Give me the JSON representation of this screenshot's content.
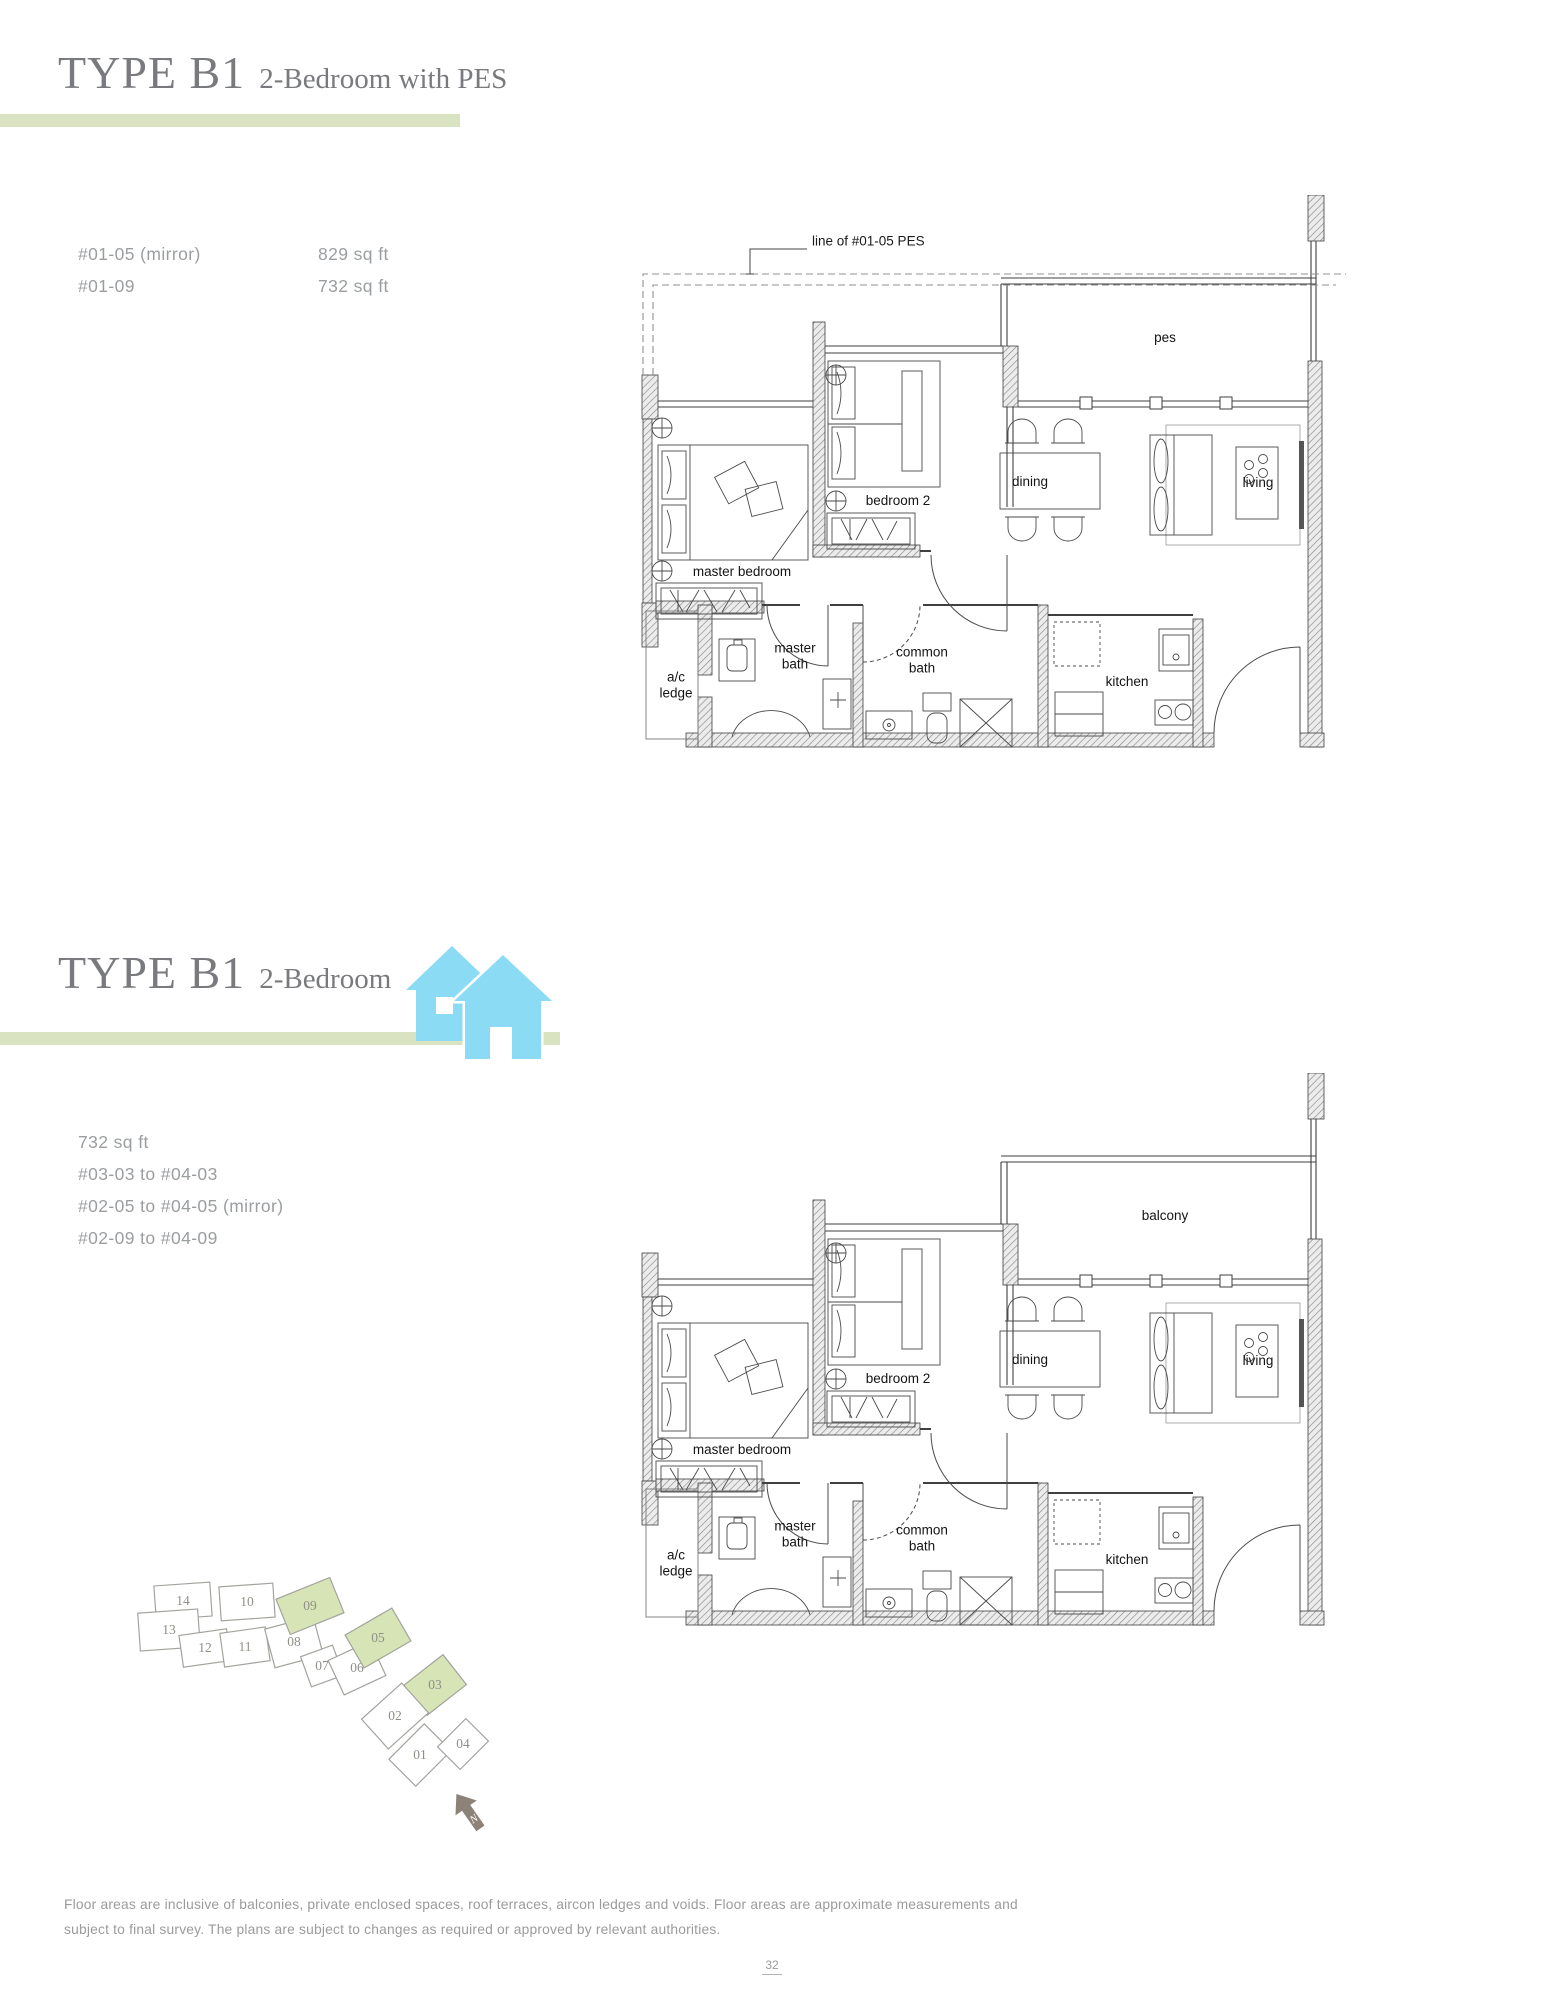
{
  "sections": [
    {
      "title": "TYPE B1",
      "subtitle": "2-Bedroom with PES",
      "unit_rows": [
        {
          "unit": "#01-05 (mirror)",
          "area": "829 sq ft"
        },
        {
          "unit": "#01-09",
          "area": "732 sq ft"
        }
      ],
      "plan": {
        "annotation": "line of #01-05 PES",
        "labels": {
          "outdoor": "pes",
          "dining": "dining",
          "living": "living",
          "bedroom2": "bedroom 2",
          "master_bedroom": "master bedroom",
          "master_bath": "master\nbath",
          "common_bath": "common\nbath",
          "ac_ledge": "a/c\nledge",
          "kitchen": "kitchen"
        }
      }
    },
    {
      "title": "TYPE B1",
      "subtitle": "2-Bedroom",
      "info_lines": [
        "732 sq ft",
        "#03-03 to #04-03",
        "#02-05 to #04-05 (mirror)",
        "#02-09 to #04-09"
      ],
      "plan": {
        "labels": {
          "outdoor": "balcony",
          "dining": "dining",
          "living": "living",
          "bedroom2": "bedroom 2",
          "master_bedroom": "master bedroom",
          "master_bath": "master\nbath",
          "common_bath": "common\nbath",
          "ac_ledge": "a/c\nledge",
          "kitchen": "kitchen"
        }
      }
    }
  ],
  "site_plan": {
    "north_label": "N",
    "units": [
      {
        "label": "14",
        "highlighted": false
      },
      {
        "label": "10",
        "highlighted": false
      },
      {
        "label": "13",
        "highlighted": false
      },
      {
        "label": "12",
        "highlighted": false
      },
      {
        "label": "11",
        "highlighted": false
      },
      {
        "label": "08",
        "highlighted": false
      },
      {
        "label": "09",
        "highlighted": true
      },
      {
        "label": "07",
        "highlighted": false
      },
      {
        "label": "06",
        "highlighted": false
      },
      {
        "label": "05",
        "highlighted": true
      },
      {
        "label": "03",
        "highlighted": true
      },
      {
        "label": "02",
        "highlighted": false
      },
      {
        "label": "01",
        "highlighted": false
      },
      {
        "label": "04",
        "highlighted": false
      }
    ]
  },
  "footer": {
    "line1": "Floor areas are inclusive of balconies, private enclosed spaces, roof terraces, aircon ledges and voids. Floor areas are approximate measurements and",
    "line2": "subject to final survey. The plans are subject to changes as required or approved by relevant authorities."
  },
  "page_number": "32",
  "colors": {
    "accent_bar": "#d9e3c1",
    "site_highlight": "#d6e4b6",
    "icon_blue": "#8bdbf5",
    "title_gray": "#797a7d"
  }
}
